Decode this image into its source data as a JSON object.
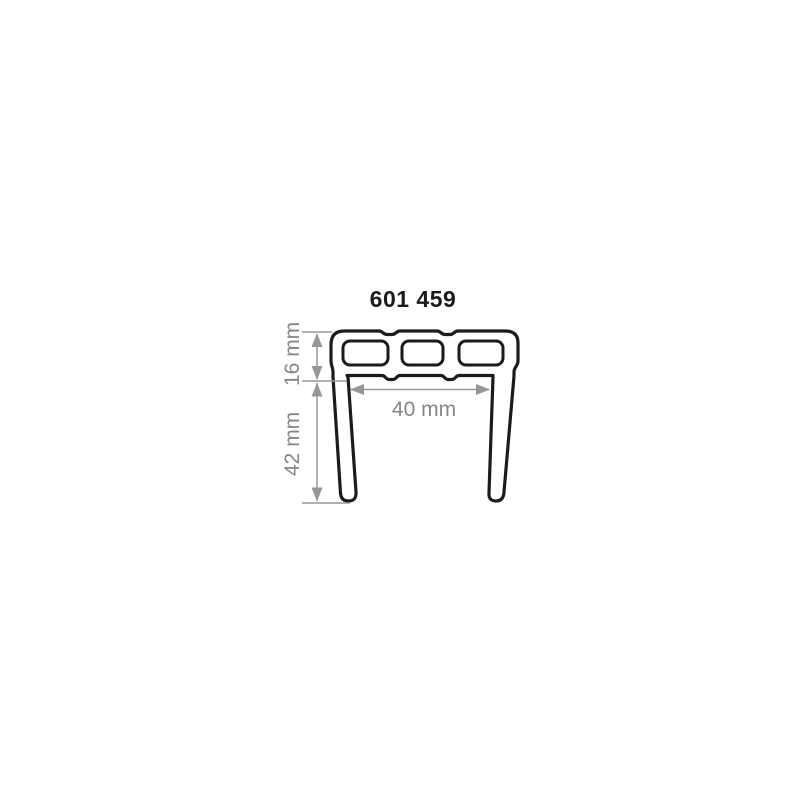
{
  "part_number": "601 459",
  "diagram": {
    "type": "extrusion-profile-cross-section",
    "description": "U-shaped profile: hollow top bar with three chambers and two downward legs",
    "colors": {
      "background": "#ffffff",
      "outline": "#1b1b1b",
      "dimension_line": "#979797",
      "dimension_text": "#868686"
    }
  },
  "dimensions": {
    "top_height": {
      "label": "16 mm",
      "value": 16,
      "unit": "mm",
      "orientation": "vertical"
    },
    "leg_height": {
      "label": "42 mm",
      "value": 42,
      "unit": "mm",
      "orientation": "vertical"
    },
    "inner_width": {
      "label": "40 mm",
      "value": 40,
      "unit": "mm",
      "orientation": "horizontal"
    }
  }
}
